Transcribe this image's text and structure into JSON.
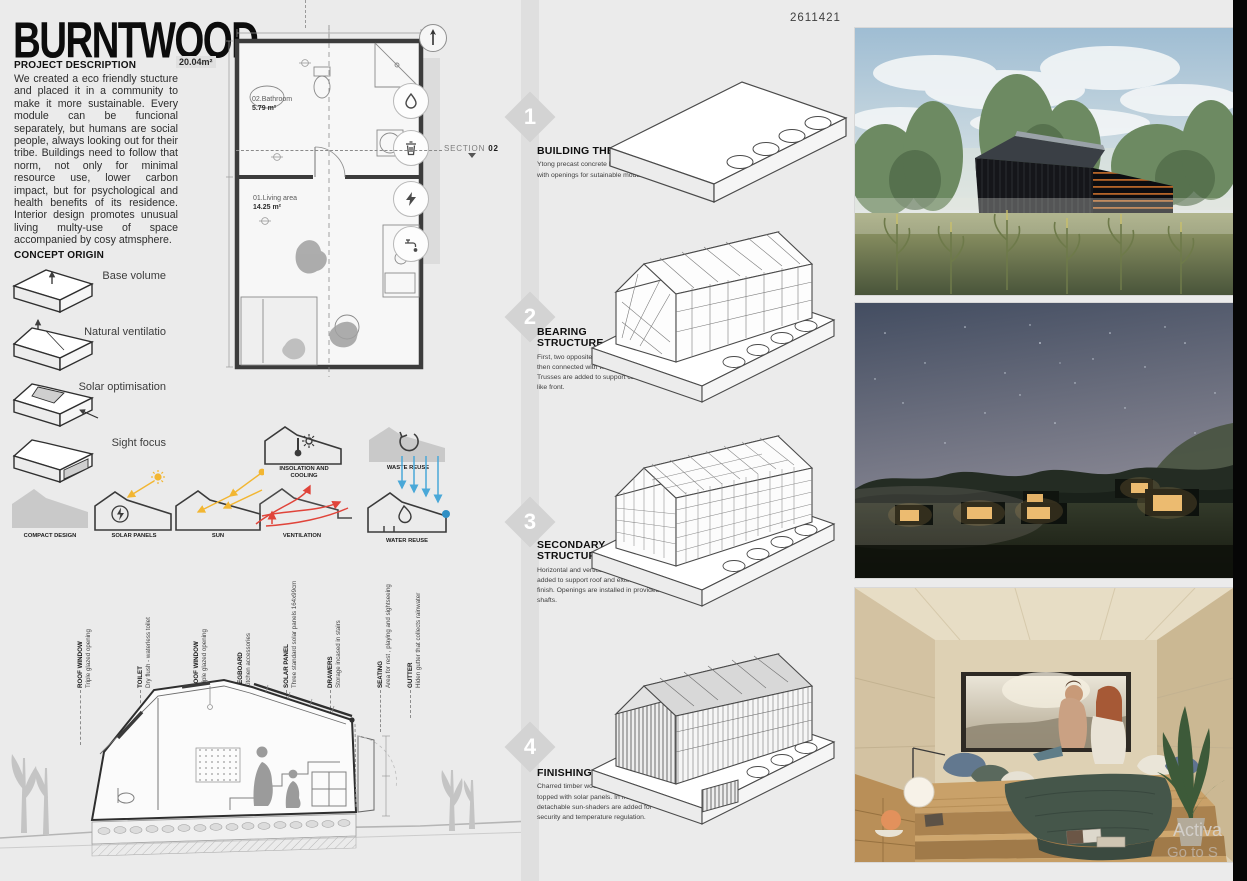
{
  "page": {
    "id_number": "2611421",
    "background_color": "#ebebeb",
    "accent_sun": "#f2b632",
    "accent_ventilation": "#e0443a",
    "accent_water": "#4aa8d8"
  },
  "title": "BURNTWOOD",
  "project": {
    "heading": "PROJECT DESCRIPTION",
    "body": "We created a eco friendly stucture and placed it in a community to make it more sustainable. Every module can be funcional separately, but humans are social people, always looking out for their tribe. Buildings need to follow that norm, not only for minimal resource use, lower carbon impact, but for psychological and health benefits of its residence. Interior design promotes unusual living multy-use of space accompanied by cosy atmsphere."
  },
  "concept": {
    "heading": "CONCEPT ORIGIN",
    "items": [
      {
        "label": "Base volume"
      },
      {
        "label": "Natural ventilatio"
      },
      {
        "label": "Solar optimisation"
      },
      {
        "label": "Sight focus"
      }
    ]
  },
  "strategies": {
    "insolation": "INSOLATION AND COOLING",
    "waste": "WASTE REUSE",
    "compact": "COMPACT DESIGN",
    "solar": "SOLAR PANELS",
    "sun": "SUN",
    "ventilation": "VENTILATION",
    "water": "WATER REUSE"
  },
  "plan": {
    "total_area": "20.04m²",
    "bathroom_name": "02.Bathroom",
    "bathroom_area": "5.79 m²",
    "living_name": "01.Living area",
    "living_area": "14.25 m²",
    "section_prefix": "SECTION",
    "section_number": "02",
    "utility_icons": [
      "water-drop",
      "trash",
      "electricity",
      "faucet"
    ]
  },
  "callouts": [
    {
      "title": "ROOF WINDOW",
      "desc": "Triple glazed opening"
    },
    {
      "title": "TOILET",
      "desc": "Dry flush - waterless toilet"
    },
    {
      "title": "ROOF WINDOW",
      "desc": "Triple glazed opening"
    },
    {
      "title": "PEGBOARD",
      "desc": "Kitchen accessories"
    },
    {
      "title": "SOLAR PANEL",
      "desc": "Three standard solar panels 164x99cm"
    },
    {
      "title": "DRAWERS",
      "desc": "Storage incased in stairs"
    },
    {
      "title": "SEATING",
      "desc": "Area for rest , playing and sightseeing"
    },
    {
      "title": "GUTTER",
      "desc": "Hiden gutter that collects rainwater"
    }
  ],
  "steps": [
    {
      "number": "1",
      "title": "BUILDING THE PAD",
      "desc": "Ytong precast concrete buidling pad, with openings for sutainable modules."
    },
    {
      "number": "2",
      "title": "BEARING STRUCTURE",
      "desc": "First, two opposite frames are constructed, then connected with wooden beams. Trusses are added to support cantilever-like front."
    },
    {
      "number": "3",
      "title": "SECONDARY STRUCTURE",
      "desc": "Horizontal and vertical woodwork is added to support roof and exterior wall finish. Openings are installed in provided shafts."
    },
    {
      "number": "4",
      "title": "FINISHING",
      "desc": "Charred timber woodwork is added, then topped with solar panels. In front, detachable sun-shaders are added for security and temperature regulation."
    }
  ],
  "photos": [
    {
      "name": "exterior daylight render"
    },
    {
      "name": "night community render"
    },
    {
      "name": "interior bedroom render"
    }
  ],
  "watermark": {
    "line1": "Activa",
    "line2": "Go to S"
  }
}
